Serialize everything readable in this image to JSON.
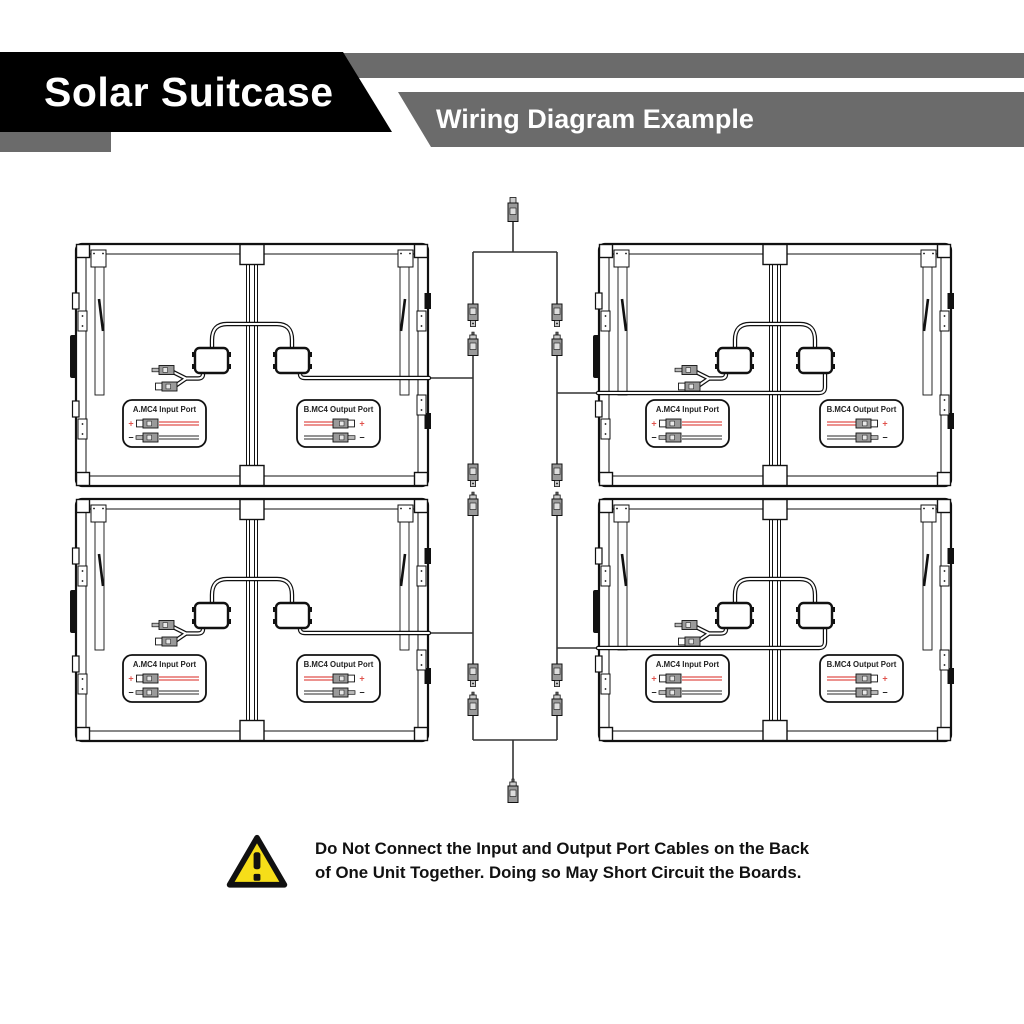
{
  "header": {
    "product_title": "Solar Suitcase",
    "banner_title": "Wiring Diagram Example"
  },
  "units": [
    {
      "name": "unit-top-left",
      "input_label": "A.MC4 Input Port",
      "output_label": "B.MC4 Output Port"
    },
    {
      "name": "unit-top-right",
      "input_label": "A.MC4 Input Port",
      "output_label": "B.MC4 Output Port"
    },
    {
      "name": "unit-bottom-left",
      "input_label": "A.MC4 Input Port",
      "output_label": "B.MC4 Output Port"
    },
    {
      "name": "unit-bottom-right",
      "input_label": "A.MC4 Input Port",
      "output_label": "B.MC4 Output Port"
    }
  ],
  "signs": {
    "plus": "+",
    "minus": "−"
  },
  "warning": {
    "line1": "Do Not Connect the Input and Output Port Cables on the Back",
    "line2": "of One Unit Together. Doing so May Short Circuit the Boards."
  },
  "colors": {
    "bar_gray": "#6b6b6b",
    "banner_black": "#000000",
    "wire_red": "#e0524c",
    "wire_dark": "#555555",
    "diagram_stroke": "#1a1a1a",
    "harness_stroke": "#333333",
    "connector_gray": "#9a9a9a",
    "warning_yellow": "#f6de19"
  }
}
